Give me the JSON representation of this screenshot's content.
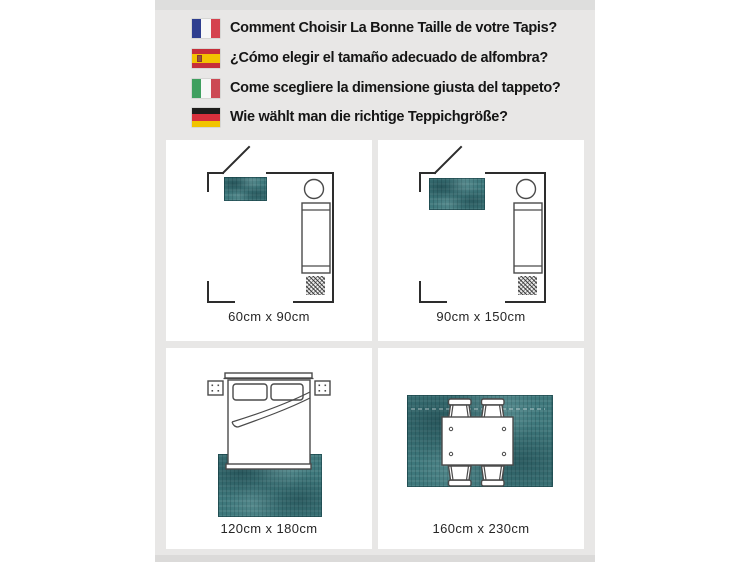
{
  "header": {
    "items": [
      {
        "icon": "france-flag-icon",
        "lang": "fr",
        "text": "Comment Choisir La Bonne Taille de votre Tapis?"
      },
      {
        "icon": "spain-flag-icon",
        "lang": "es",
        "text": "¿Cómo elegir el tamaño adecuado de alfombra?"
      },
      {
        "icon": "italy-flag-icon",
        "lang": "it",
        "text": "Come scegliere la dimensione giusta del tappeto?"
      },
      {
        "icon": "germany-flag-icon",
        "lang": "de",
        "text": "Wie wählt man die richtige Teppichgröße?"
      }
    ]
  },
  "panels": [
    {
      "name": "bedside-rug-small",
      "label": "60cm x 90cm"
    },
    {
      "name": "bedside-rug-medium",
      "label": "90cm x 150cm"
    },
    {
      "name": "bed-end-rug",
      "label": "120cm x 180cm"
    },
    {
      "name": "dining-table-rug",
      "label": "160cm x 230cm"
    }
  ],
  "colors": {
    "rug": "#3e787c",
    "line": "#2d2d2d",
    "furn": "#4a4a4a",
    "col_bg": "#e8e7e6",
    "col_top": "#dededd",
    "col_bottom": "#dbdad9",
    "fr_blue": "#2e3e8f",
    "fr_red": "#d5424e",
    "es_red": "#c62f3a",
    "es_yellow": "#f3c300",
    "it_green": "#3f9f5f",
    "it_red": "#cc4a54",
    "de_black": "#1d1d1b",
    "de_red": "#d8303c",
    "de_gold": "#f1c400"
  }
}
